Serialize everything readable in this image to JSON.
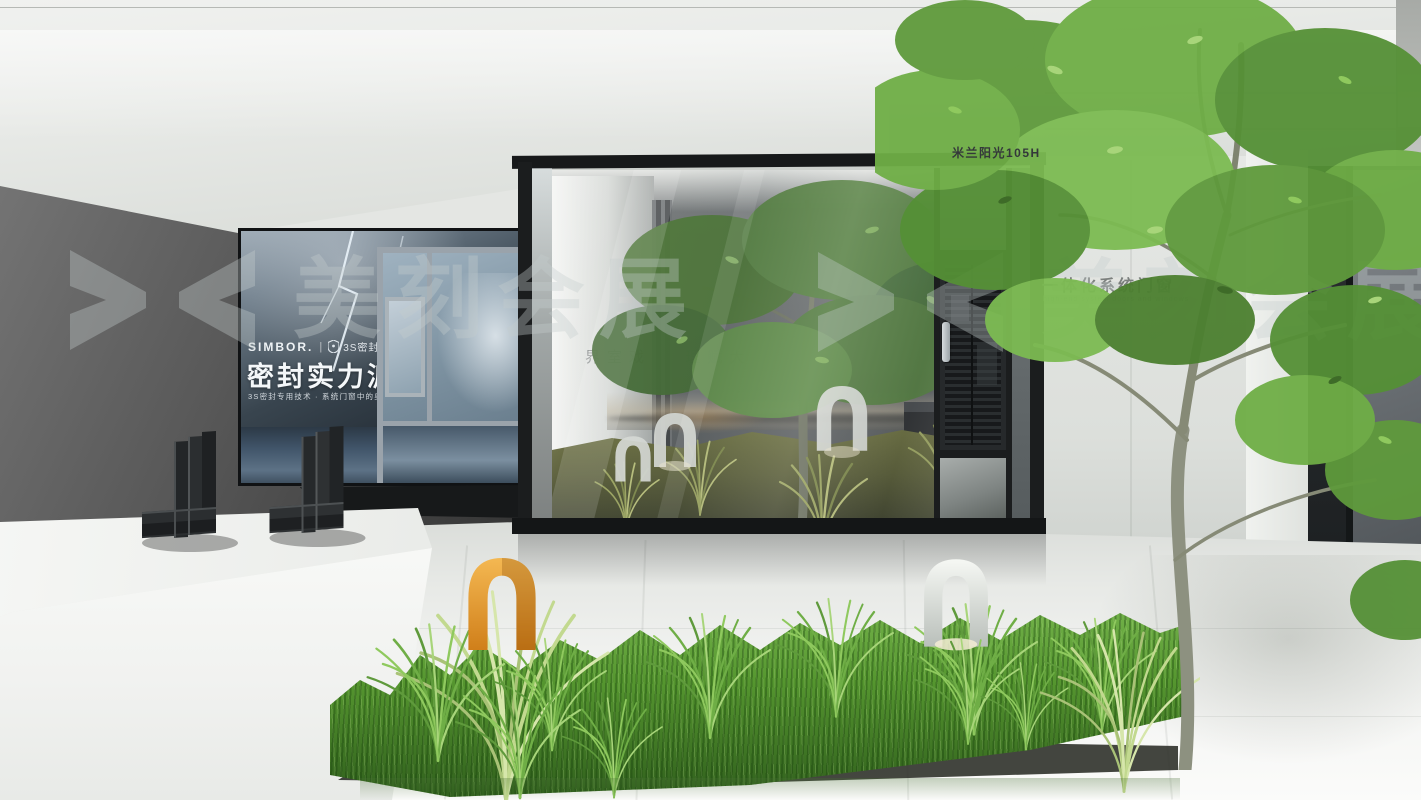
{
  "top_label": {
    "text": "米兰阳光105H"
  },
  "watermark": {
    "text": "美刻会展",
    "logo": "bowtie-logo",
    "color": "#c6ccce"
  },
  "billboard": {
    "brand": "SIMBOR.",
    "divider": "|",
    "badge_icon": "shield-icon",
    "badge": "3S密封技术",
    "headline": "密封实力派",
    "tagline": "3S密封专用技术 · 系统门窗中的奥迪"
  },
  "glass_room": {
    "interior_sign": "界室戏 · 理赋大"
  },
  "right_wall": {
    "heading": "一体化系统门窗",
    "subheading": "high-end system doors and windows"
  },
  "colors": {
    "accent_orange": "#e8a13c",
    "foliage_green": "#6fae46",
    "grass_green": "#5c9c38",
    "frame_black": "#1b1d1e",
    "wall_dark": "#555555",
    "wall_light": "#e2e4e1",
    "floor_light": "#f3f4f2"
  },
  "scene_objects": [
    "billboard-lightbox",
    "window-sample",
    "corner-profile-samples",
    "glass-sunroom",
    "screen-door",
    "indoor-garden",
    "arch-lamps",
    "grass-bed",
    "foreground-tree",
    "display-podium"
  ]
}
